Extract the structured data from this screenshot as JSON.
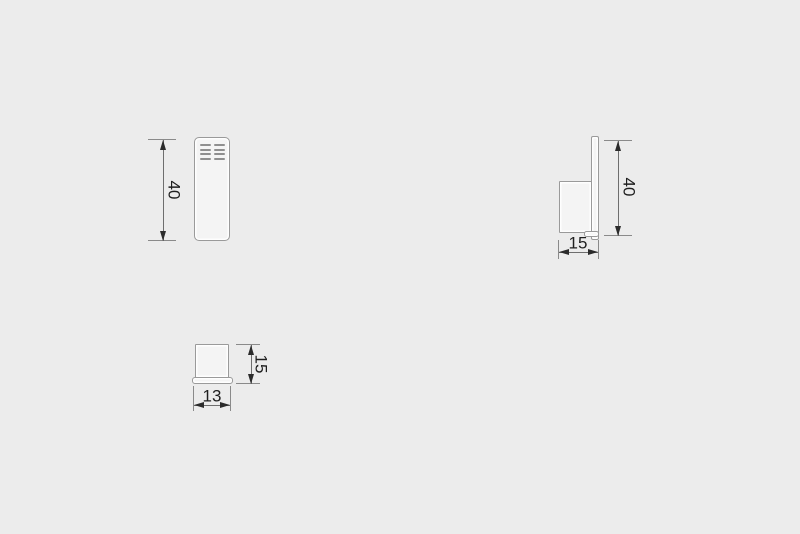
{
  "drawing": {
    "type": "technical-dimension-drawing",
    "views": [
      "front",
      "side",
      "bottom"
    ]
  },
  "dims": {
    "front_height": "40",
    "side_height": "40",
    "side_depth": "15",
    "bottom_height": "15",
    "bottom_width": "13"
  },
  "vents": {
    "rows": 4,
    "columns": 2
  },
  "colors": {
    "background": "#ececec",
    "part_fill": "#f4f4f4",
    "part_outline": "#9a9a9a",
    "dim_line": "#6e6e6e",
    "extension_line": "#8a8a8a",
    "arrow": "#2b2b2b",
    "text": "#1f1f1f",
    "vent": "#8f8f8f"
  }
}
